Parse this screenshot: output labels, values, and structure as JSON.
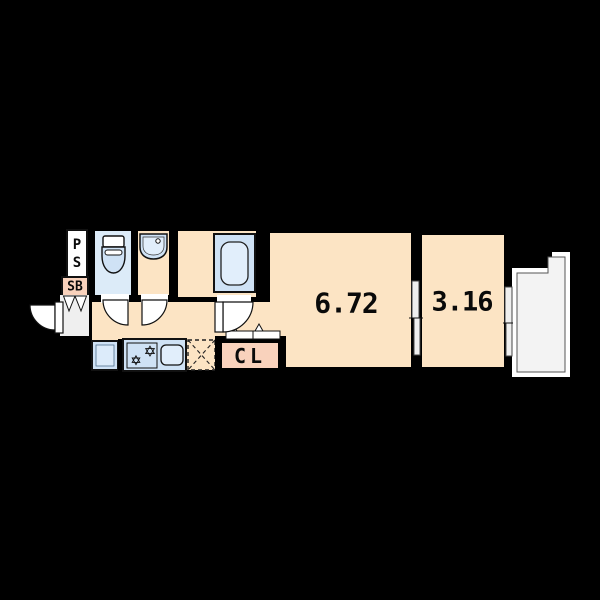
{
  "diagram": {
    "type": "apartment-floor-plan",
    "labels": {
      "pipe_space": [
        "P",
        "S"
      ],
      "shoe_box": "SB",
      "closet": "CL"
    },
    "areas": {
      "main_room": "6.72",
      "second_room": "3.16"
    },
    "colors": {
      "background": "#000000",
      "wall": "#000000",
      "floor_cream": "#fce4c4",
      "closet_salmon": "#f9d2bc",
      "toilet_room_blue": "#dcebf8",
      "fixture_blue": "#cfe2f5",
      "fixture_blue_light": "#e1eefb",
      "entry_grey": "#efefef",
      "balcony_grey": "#f3f3f3",
      "outline": "#111111"
    }
  }
}
